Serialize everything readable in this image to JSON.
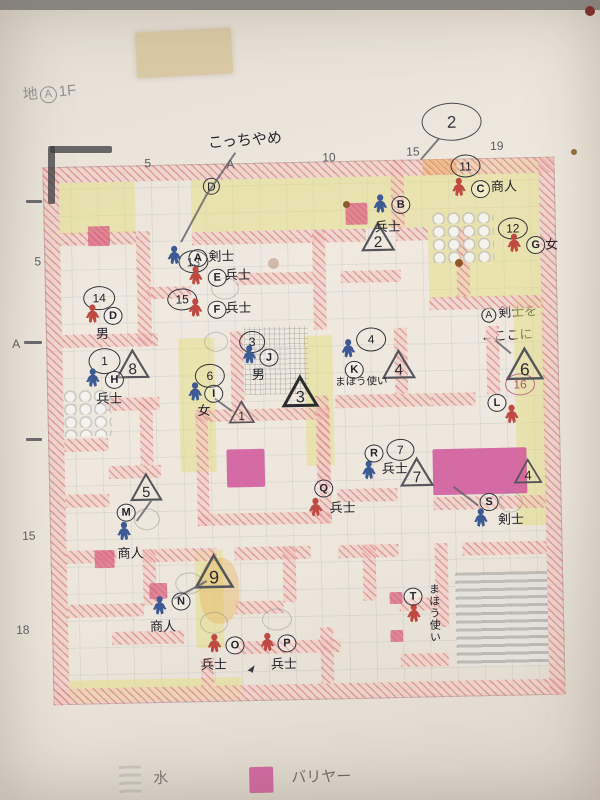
{
  "title": {
    "prefix": "地",
    "circled": "A",
    "suffix": "1F"
  },
  "notes": {
    "kocchi": "こっちやめ",
    "place_circle": "A",
    "place_text": "剣士を",
    "place_arrow": "←ここに",
    "balloon": "2",
    "small_circled": "D"
  },
  "legend": {
    "water": "水",
    "barrier": "バリヤー"
  },
  "colors": {
    "figure_blue": "#3d5a94",
    "figure_red": "#bf4a42",
    "barrier": "#d0559a",
    "wall_pink": "#d36a64",
    "wall_orange": "#d6803a",
    "yellow": "#e2dd80",
    "pencil": "#5c5c64",
    "ink": "#26262e"
  },
  "axis": {
    "top": [
      {
        "t": "5",
        "x": 150,
        "y": 154
      },
      {
        "t": "A",
        "x": 232,
        "y": 157
      },
      {
        "t": "10",
        "x": 328,
        "y": 152
      },
      {
        "t": "15",
        "x": 412,
        "y": 148
      },
      {
        "t": "19",
        "x": 496,
        "y": 144
      }
    ],
    "left": [
      {
        "t": "5",
        "x": 38,
        "y": 250
      },
      {
        "t": "A",
        "x": 14,
        "y": 332
      },
      {
        "t": "15",
        "x": 20,
        "y": 524
      },
      {
        "t": "18",
        "x": 12,
        "y": 618
      }
    ]
  },
  "map": {
    "yellow": [
      {
        "x": 64,
        "y": 178,
        "w": 76,
        "h": 52
      },
      {
        "x": 196,
        "y": 178,
        "w": 236,
        "h": 52
      },
      {
        "x": 432,
        "y": 163,
        "w": 112,
        "h": 138
      },
      {
        "x": 516,
        "y": 302,
        "w": 30,
        "h": 172
      },
      {
        "x": 516,
        "y": 474,
        "w": 30,
        "h": 56
      },
      {
        "x": 180,
        "y": 336,
        "w": 36,
        "h": 134
      },
      {
        "x": 306,
        "y": 336,
        "w": 28,
        "h": 130
      },
      {
        "x": 192,
        "y": 548,
        "w": 28,
        "h": 98
      },
      {
        "x": 64,
        "y": 676,
        "w": 172,
        "h": 22
      }
    ],
    "walls": [
      {
        "x": 48,
        "y": 162,
        "w": 512,
        "h": 16
      },
      {
        "x": 48,
        "y": 684,
        "w": 512,
        "h": 16
      },
      {
        "x": 48,
        "y": 162,
        "w": 16,
        "h": 538
      },
      {
        "x": 544,
        "y": 162,
        "w": 16,
        "h": 538
      },
      {
        "x": 428,
        "y": 162,
        "w": 34,
        "h": 16,
        "c": "orange"
      },
      {
        "x": 64,
        "y": 228,
        "w": 76,
        "h": 13
      },
      {
        "x": 196,
        "y": 230,
        "w": 120,
        "h": 13
      },
      {
        "x": 316,
        "y": 230,
        "w": 54,
        "h": 13
      },
      {
        "x": 400,
        "y": 230,
        "w": 32,
        "h": 13
      },
      {
        "x": 432,
        "y": 300,
        "w": 112,
        "h": 13
      },
      {
        "x": 64,
        "y": 330,
        "w": 96,
        "h": 13
      },
      {
        "x": 150,
        "y": 284,
        "w": 44,
        "h": 12
      },
      {
        "x": 240,
        "y": 272,
        "w": 76,
        "h": 12
      },
      {
        "x": 344,
        "y": 272,
        "w": 60,
        "h": 12
      },
      {
        "x": 336,
        "y": 396,
        "w": 96,
        "h": 13
      },
      {
        "x": 432,
        "y": 396,
        "w": 44,
        "h": 13
      },
      {
        "x": 64,
        "y": 434,
        "w": 44,
        "h": 13
      },
      {
        "x": 108,
        "y": 394,
        "w": 52,
        "h": 13
      },
      {
        "x": 64,
        "y": 490,
        "w": 44,
        "h": 13
      },
      {
        "x": 108,
        "y": 462,
        "w": 52,
        "h": 13
      },
      {
        "x": 64,
        "y": 546,
        "w": 50,
        "h": 13
      },
      {
        "x": 140,
        "y": 546,
        "w": 74,
        "h": 13
      },
      {
        "x": 232,
        "y": 546,
        "w": 76,
        "h": 13
      },
      {
        "x": 336,
        "y": 546,
        "w": 60,
        "h": 13
      },
      {
        "x": 460,
        "y": 546,
        "w": 84,
        "h": 13
      },
      {
        "x": 64,
        "y": 600,
        "w": 76,
        "h": 13
      },
      {
        "x": 232,
        "y": 600,
        "w": 48,
        "h": 13
      },
      {
        "x": 396,
        "y": 600,
        "w": 36,
        "h": 13
      },
      {
        "x": 108,
        "y": 628,
        "w": 72,
        "h": 13
      },
      {
        "x": 232,
        "y": 640,
        "w": 104,
        "h": 13
      },
      {
        "x": 396,
        "y": 656,
        "w": 48,
        "h": 13
      },
      {
        "x": 336,
        "y": 490,
        "w": 60,
        "h": 13
      },
      {
        "x": 432,
        "y": 500,
        "w": 112,
        "h": 13
      },
      {
        "x": 140,
        "y": 228,
        "w": 14,
        "h": 115
      },
      {
        "x": 316,
        "y": 230,
        "w": 13,
        "h": 100
      },
      {
        "x": 396,
        "y": 162,
        "w": 13,
        "h": 68
      },
      {
        "x": 460,
        "y": 230,
        "w": 13,
        "h": 70
      },
      {
        "x": 140,
        "y": 396,
        "w": 13,
        "h": 66
      },
      {
        "x": 232,
        "y": 330,
        "w": 13,
        "h": 80
      },
      {
        "x": 316,
        "y": 396,
        "w": 13,
        "h": 94
      },
      {
        "x": 396,
        "y": 330,
        "w": 13,
        "h": 66
      },
      {
        "x": 488,
        "y": 330,
        "w": 13,
        "h": 68
      },
      {
        "x": 140,
        "y": 546,
        "w": 13,
        "h": 56
      },
      {
        "x": 280,
        "y": 546,
        "w": 13,
        "h": 56
      },
      {
        "x": 360,
        "y": 546,
        "w": 13,
        "h": 56
      },
      {
        "x": 432,
        "y": 546,
        "w": 13,
        "h": 84
      },
      {
        "x": 316,
        "y": 628,
        "w": 13,
        "h": 56
      },
      {
        "x": 196,
        "y": 656,
        "w": 13,
        "h": 28
      },
      {
        "x": 196,
        "y": 408,
        "w": 134,
        "h": 12
      },
      {
        "x": 196,
        "y": 512,
        "w": 134,
        "h": 12
      },
      {
        "x": 196,
        "y": 408,
        "w": 12,
        "h": 116
      },
      {
        "x": 318,
        "y": 408,
        "w": 12,
        "h": 116
      }
    ],
    "water": [
      {
        "x": 452,
        "y": 576,
        "w": 92,
        "h": 94
      }
    ],
    "bumps": [
      {
        "x": 436,
        "y": 214,
        "w": 62,
        "h": 52
      },
      {
        "x": 64,
        "y": 384,
        "w": 48,
        "h": 48
      }
    ],
    "crosshatch": [
      {
        "x": 246,
        "y": 326,
        "w": 64,
        "h": 68
      }
    ],
    "barriers": [
      {
        "x": 226,
        "y": 448,
        "w": 38,
        "h": 38
      },
      {
        "x": 432,
        "y": 452,
        "w": 94,
        "h": 46
      }
    ],
    "barriers_small": [
      {
        "x": 92,
        "y": 222,
        "w": 22,
        "h": 20
      },
      {
        "x": 350,
        "y": 204,
        "w": 22,
        "h": 22
      },
      {
        "x": 92,
        "y": 546,
        "w": 20,
        "h": 18
      },
      {
        "x": 146,
        "y": 580,
        "w": 18,
        "h": 16
      },
      {
        "x": 386,
        "y": 594,
        "w": 13,
        "h": 12
      },
      {
        "x": 386,
        "y": 632,
        "w": 13,
        "h": 12
      }
    ],
    "smudges": [
      {
        "x": 196,
        "y": 556,
        "w": 40,
        "h": 66
      }
    ],
    "figures": [
      {
        "letter": "A",
        "type": "剣士",
        "color": "blue",
        "px": 170,
        "py": 243,
        "cx": 192,
        "cy": 247,
        "lx": 212,
        "ly": 248
      },
      {
        "letter": "B",
        "type": "兵士",
        "color": "blue",
        "px": 377,
        "py": 196,
        "cx": 396,
        "cy": 198,
        "lx": 379,
        "ly": 222
      },
      {
        "letter": "C",
        "type": "商人",
        "color": "red",
        "px": 456,
        "py": 181,
        "cx": 476,
        "cy": 184,
        "lx": 496,
        "ly": 184
      },
      {
        "letter": "D",
        "type": "男",
        "color": "red",
        "px": 87,
        "py": 300,
        "cx": 106,
        "cy": 303,
        "lx": 98,
        "ly": 323
      },
      {
        "letter": "E",
        "type": "兵士",
        "color": "red",
        "px": 191,
        "py": 264,
        "cx": 211,
        "cy": 267,
        "lx": 228,
        "ly": 267
      },
      {
        "letter": "F",
        "type": "兵士",
        "color": "red",
        "px": 190,
        "py": 296,
        "cx": 210,
        "cy": 299,
        "lx": 228,
        "ly": 300
      },
      {
        "letter": "G",
        "type": "女",
        "color": "red",
        "px": 510,
        "py": 238,
        "cx": 530,
        "cy": 241,
        "lx": 549,
        "ly": 243
      },
      {
        "letter": "H",
        "type": "兵士",
        "color": "blue",
        "px": 86,
        "py": 364,
        "cx": 106,
        "cy": 367,
        "lx": 97,
        "ly": 388
      },
      {
        "letter": "I",
        "type": "女",
        "color": "blue",
        "px": 188,
        "py": 380,
        "cx": 205,
        "cy": 383,
        "lx": 198,
        "ly": 402
      },
      {
        "letter": "J",
        "type": "男",
        "color": "blue",
        "px": 243,
        "py": 344,
        "cx": 261,
        "cy": 348,
        "lx": 253,
        "ly": 367
      },
      {
        "letter": "K",
        "type": "まほう使い",
        "color": "blue",
        "px": 342,
        "py": 340,
        "cx": 346,
        "cy": 362,
        "lx": 336,
        "ly": 378,
        "small": true
      },
      {
        "letter": "L",
        "type": "",
        "color": "red",
        "px": 504,
        "py": 409,
        "cx": 488,
        "cy": 398,
        "lx": 0,
        "ly": 0
      },
      {
        "letter": "M",
        "type": "商人",
        "color": "blue",
        "px": 114,
        "py": 518,
        "cx": 115,
        "cy": 500,
        "lx": 115,
        "ly": 543
      },
      {
        "letter": "N",
        "type": "商人",
        "color": "blue",
        "px": 148,
        "py": 593,
        "cx": 168,
        "cy": 590,
        "lx": 146,
        "ly": 617
      },
      {
        "letter": "O",
        "type": "兵士",
        "color": "red",
        "px": 202,
        "py": 632,
        "cx": 221,
        "cy": 635,
        "lx": 196,
        "ly": 656
      },
      {
        "letter": "P",
        "type": "兵士",
        "color": "red",
        "px": 255,
        "py": 632,
        "cx": 273,
        "cy": 634,
        "lx": 266,
        "ly": 657
      },
      {
        "letter": "Q",
        "type": "兵士",
        "color": "red",
        "px": 306,
        "py": 498,
        "cx": 313,
        "cy": 480,
        "lx": 328,
        "ly": 502
      },
      {
        "letter": "R",
        "type": "兵士",
        "color": "blue",
        "px": 360,
        "py": 462,
        "cx": 364,
        "cy": 446,
        "lx": 381,
        "ly": 464
      },
      {
        "letter": "S",
        "type": "剣士",
        "color": "blue",
        "px": 471,
        "py": 512,
        "cx": 478,
        "cy": 497,
        "lx": 496,
        "ly": 517
      },
      {
        "letter": "T",
        "type": "まほう使い",
        "color": "red",
        "px": 402,
        "py": 606,
        "cx": 400,
        "cy": 590,
        "lx": 424,
        "ly": 586,
        "vertical": true
      }
    ],
    "triangles": [
      {
        "n": "2",
        "x": 364,
        "y": 222,
        "s": 36
      },
      {
        "n": "8",
        "x": 116,
        "y": 344,
        "s": 36
      },
      {
        "n": "1",
        "x": 228,
        "y": 398,
        "s": 28
      },
      {
        "n": "3",
        "x": 282,
        "y": 374,
        "s": 38,
        "dark": true
      },
      {
        "n": "4",
        "x": 382,
        "y": 350,
        "s": 36
      },
      {
        "n": "6",
        "x": 506,
        "y": 350,
        "s": 40
      },
      {
        "n": "7",
        "x": 398,
        "y": 458,
        "s": 36
      },
      {
        "n": "5",
        "x": 128,
        "y": 468,
        "s": 34
      },
      {
        "n": "9",
        "x": 190,
        "y": 550,
        "s": 42
      },
      {
        "n": "4",
        "x": 512,
        "y": 462,
        "s": 30
      }
    ],
    "circles": [
      {
        "t": "2",
        "x": 428,
        "y": 106,
        "w": 58,
        "h": 36,
        "s": "big"
      },
      {
        "t": "D",
        "x": 208,
        "y": 176,
        "w": 15,
        "h": 15
      },
      {
        "t": "11",
        "x": 456,
        "y": 158,
        "w": 28,
        "h": 21
      },
      {
        "t": "12",
        "x": 502,
        "y": 222,
        "w": 28,
        "h": 20
      },
      {
        "t": "13",
        "x": 182,
        "y": 248,
        "w": 28,
        "h": 21
      },
      {
        "t": "14",
        "x": 86,
        "y": 282,
        "w": 30,
        "h": 22
      },
      {
        "t": "15",
        "x": 170,
        "y": 286,
        "w": 28,
        "h": 20
      },
      {
        "t": "16",
        "x": 506,
        "y": 378,
        "w": 28,
        "h": 20,
        "s": "pinkink"
      },
      {
        "t": "1",
        "x": 90,
        "y": 344,
        "w": 30,
        "h": 24
      },
      {
        "t": "6",
        "x": 196,
        "y": 362,
        "w": 28,
        "h": 22
      },
      {
        "t": "3",
        "x": 241,
        "y": 330,
        "w": 24,
        "h": 20
      },
      {
        "t": "4",
        "x": 358,
        "y": 329,
        "w": 28,
        "h": 22
      },
      {
        "t": "7",
        "x": 386,
        "y": 441,
        "w": 26,
        "h": 20
      },
      {
        "t": "",
        "x": 206,
        "y": 330,
        "w": 22,
        "h": 18,
        "s": "faint"
      },
      {
        "t": "",
        "x": 214,
        "y": 276,
        "w": 26,
        "h": 20,
        "s": "faint"
      },
      {
        "t": "",
        "x": 132,
        "y": 505,
        "w": 24,
        "h": 20,
        "s": "faint"
      },
      {
        "t": "",
        "x": 497,
        "y": 496,
        "w": 22,
        "h": 19,
        "s": "faint"
      },
      {
        "t": "",
        "x": 172,
        "y": 570,
        "w": 26,
        "h": 20,
        "s": "faint"
      },
      {
        "t": "",
        "x": 196,
        "y": 610,
        "w": 26,
        "h": 20,
        "s": "faint"
      },
      {
        "t": "",
        "x": 258,
        "y": 608,
        "w": 28,
        "h": 20,
        "s": "faint"
      }
    ],
    "lines": [
      {
        "x1": 242,
        "y1": 152,
        "x2": 212,
        "y2": 194
      },
      {
        "x1": 212,
        "y1": 194,
        "x2": 186,
        "y2": 240
      },
      {
        "x1": 446,
        "y1": 142,
        "x2": 427,
        "y2": 163
      },
      {
        "x1": 476,
        "y1": 510,
        "x2": 452,
        "y2": 491
      },
      {
        "x1": 498,
        "y1": 344,
        "x2": 513,
        "y2": 357
      },
      {
        "x1": 204,
        "y1": 580,
        "x2": 171,
        "y2": 597
      },
      {
        "x1": 134,
        "y1": 517,
        "x2": 149,
        "y2": 497
      },
      {
        "x1": 216,
        "y1": 396,
        "x2": 233,
        "y2": 409
      }
    ],
    "arrow": {
      "x": 234,
      "y": 662
    }
  },
  "artifacts": {
    "tape": {
      "x": 136,
      "y": 30,
      "w": 96,
      "h": 46
    },
    "stains": [
      {
        "x": 343,
        "y": 201,
        "d": 7,
        "c": "#8a5a2f"
      },
      {
        "x": 455,
        "y": 259,
        "d": 8,
        "c": "#96562b"
      },
      {
        "x": 571,
        "y": 149,
        "d": 6,
        "c": "#9a6a3a"
      },
      {
        "x": 585,
        "y": 6,
        "d": 10,
        "c": "#7d201c"
      },
      {
        "x": 268,
        "y": 258,
        "d": 11,
        "c": "rgba(151,103,63,0.35)"
      }
    ],
    "bracket": [
      {
        "x": 50,
        "y": 146,
        "w": 62,
        "h": 7
      },
      {
        "x": 48,
        "y": 146,
        "w": 7,
        "h": 58
      }
    ],
    "ticks": [
      {
        "x": 26,
        "y": 200,
        "w": 16,
        "h": 3
      },
      {
        "x": 24,
        "y": 341,
        "w": 18,
        "h": 3
      },
      {
        "x": 26,
        "y": 438,
        "w": 16,
        "h": 3
      }
    ]
  }
}
